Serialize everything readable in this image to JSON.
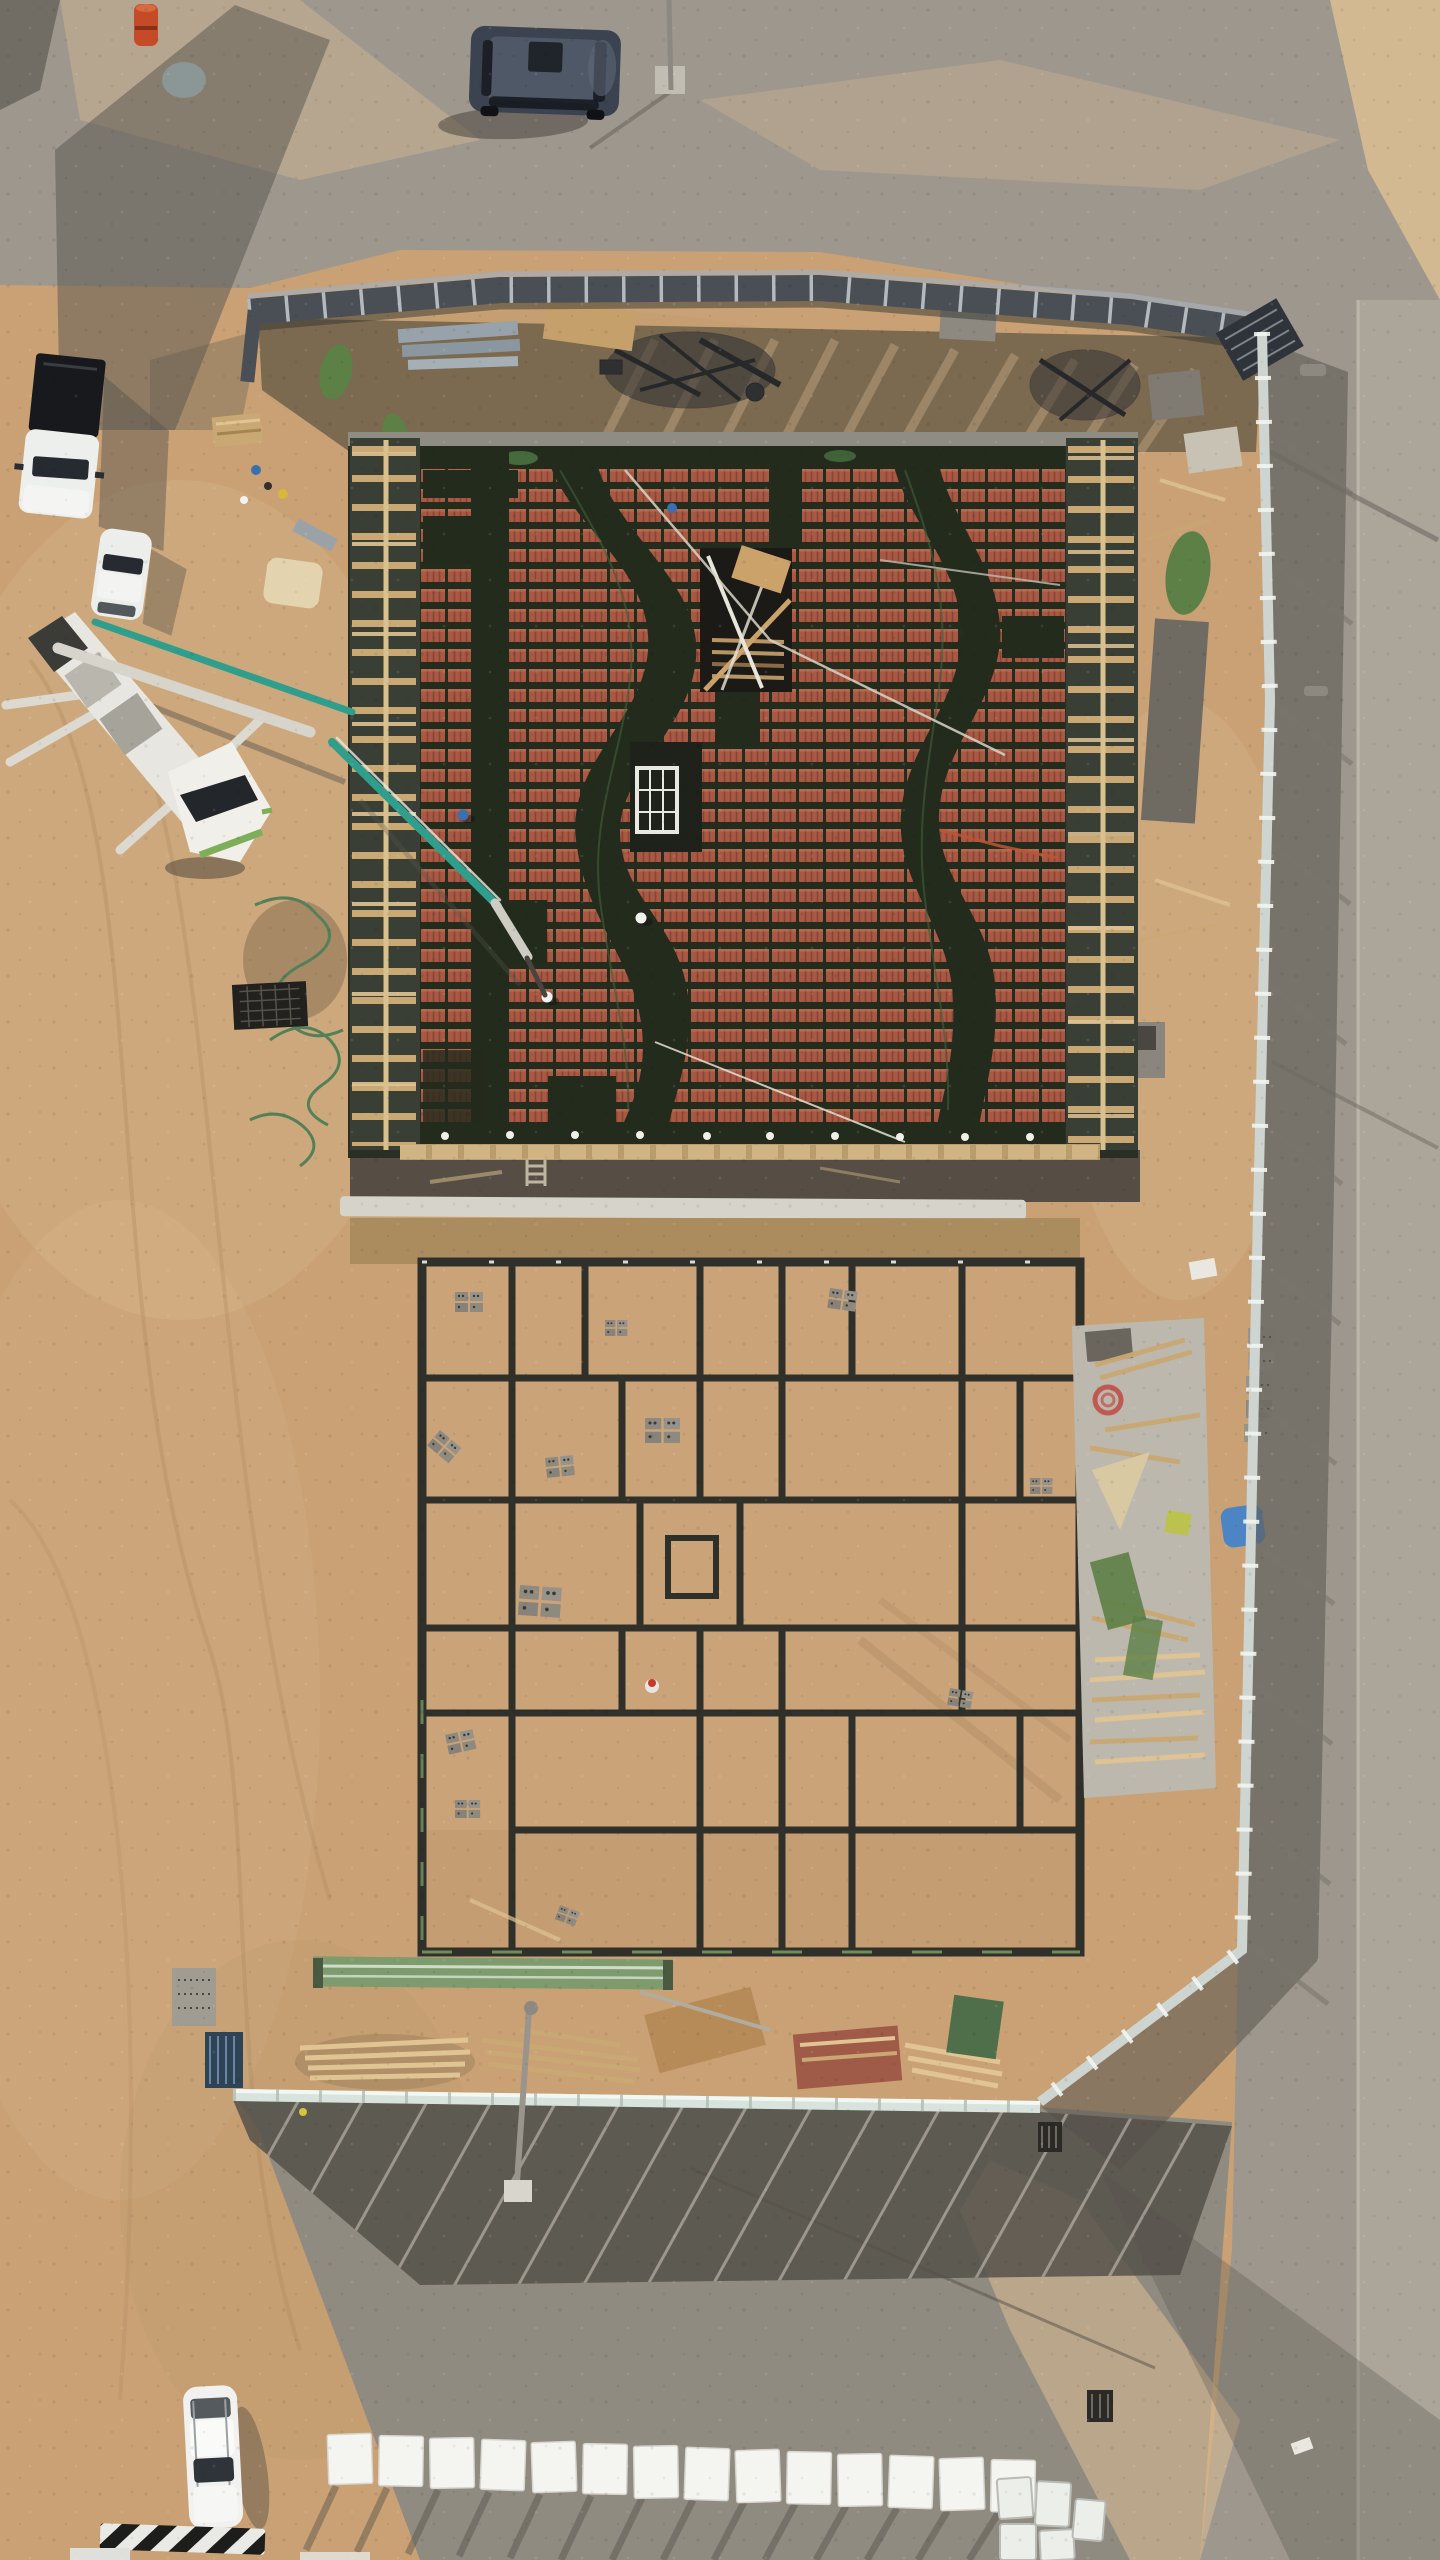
{
  "image": {
    "kind": "aerial-drone-photograph",
    "view": "top-down",
    "subject": "building construction site with hollow-block slab formwork, foundation ground-beam grid, concrete pump truck, perimeter fencing and surrounding roads",
    "scene_width_px": 1440,
    "scene_height_px": 2560
  },
  "palette": {
    "sand": "#c9a175",
    "sandLight": "#ddbe93",
    "sandDark": "#ae895f",
    "gridSand": "#cba379",
    "roadTop": "#9d978d",
    "roadBottom": "#908b81",
    "roadLight": "#b3ada2",
    "shadow": "#5f5b53",
    "shadowDark": "#4a463f",
    "fenceDark": "#4a4f55",
    "fenceLight": "#ced5d0",
    "fenceBottom": "#d7e3dc",
    "dirtStrip": "#7b6950",
    "plinth": "#d6d4ca",
    "concretePad": "#bdb8ae",
    "slabMesh": "#232b1d",
    "blockRed": "#b25a46",
    "blockRedDark": "#8e4636",
    "blockRedLight": "#c97a5e",
    "wood": "#c9a873",
    "woodLight": "#e0c493",
    "formDark": "#3a3f35",
    "beam": "#30302b",
    "white": "#f2f2ef",
    "boomTeal": "#2f9e8c",
    "truckGreen": "#7fae5a",
    "tarpGreen": "#5c8046",
    "tarpBlue": "#4d84c4",
    "suvBody": "#3b4350",
    "barrelOrange": "#c44a28"
  },
  "entities": {
    "vehicles": [
      {
        "name": "dark-suv",
        "where": "top road",
        "color_key": "suvBody"
      },
      {
        "name": "white-pickup-truck",
        "where": "upper-left sand"
      },
      {
        "name": "white-hatchback",
        "where": "left sand"
      },
      {
        "name": "concrete-pump-truck",
        "where": "left of building",
        "boom": "extended over slab"
      },
      {
        "name": "white-crossover",
        "where": "bottom road"
      }
    ],
    "structures": [
      {
        "name": "hollow-block-slab",
        "desc": "red clay block rows with dark rebar beam bands, stair and shaft openings"
      },
      {
        "name": "ground-beam-grid",
        "desc": "foundation formwork grid of rooms with central nested shaft"
      },
      {
        "name": "perimeter-fence",
        "sides": [
          "top dark corrugated",
          "right light panels",
          "bottom light panels"
        ]
      },
      {
        "name": "material-laydown",
        "desc": "timber piles, plywood, block stacks, green mesh, concrete pads"
      }
    ],
    "workers": {
      "count": 4,
      "helmet_colors": [
        "blue",
        "white",
        "white",
        "blue"
      ]
    },
    "counts": {
      "white_fence_panels_bottom_road": 14,
      "slab_pipe_sleeves": 10,
      "block_stacks_right_strip": 5
    },
    "street_furniture": [
      "light-pole-top-road",
      "light-pole-bottom-road",
      "lamp-heads-right-road",
      "traffic-drum",
      "road-drains",
      "striped-curb"
    ]
  }
}
